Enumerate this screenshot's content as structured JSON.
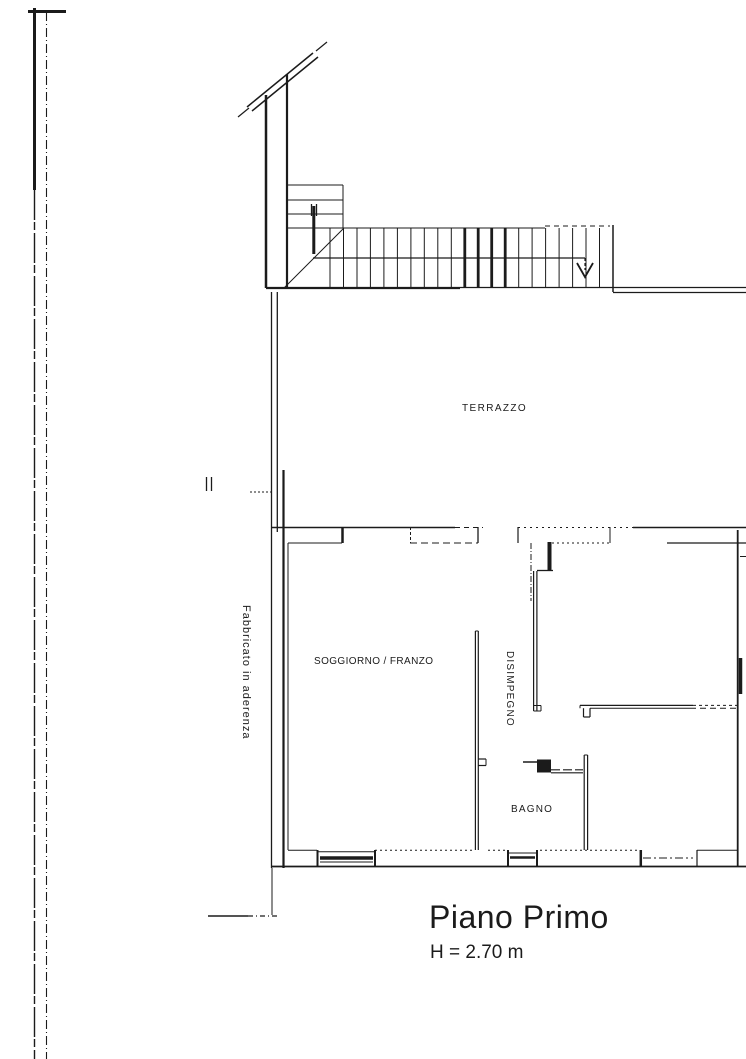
{
  "document": {
    "type": "architectural floor plan (scanned)",
    "title": "Piano Primo",
    "height_note": "H = 2.70 m",
    "ink_color": "#1b1b1b",
    "paper_color": "#ffffff"
  },
  "rooms": [
    {
      "id": "terrazzo",
      "label": "TERRAZZO"
    },
    {
      "id": "soggiorno-pranzo",
      "label": "SOGGIORNO / FRANZO"
    },
    {
      "id": "disimpegno",
      "label": "DISIMPEGNO"
    },
    {
      "id": "bagno",
      "label": "BAGNO"
    }
  ],
  "annotations": [
    {
      "id": "adjacent-building",
      "label": "Fabbricato in aderenza"
    }
  ],
  "icons": [
    {
      "id": "stairs-down-arrow",
      "meaning": "stair direction: down"
    }
  ]
}
